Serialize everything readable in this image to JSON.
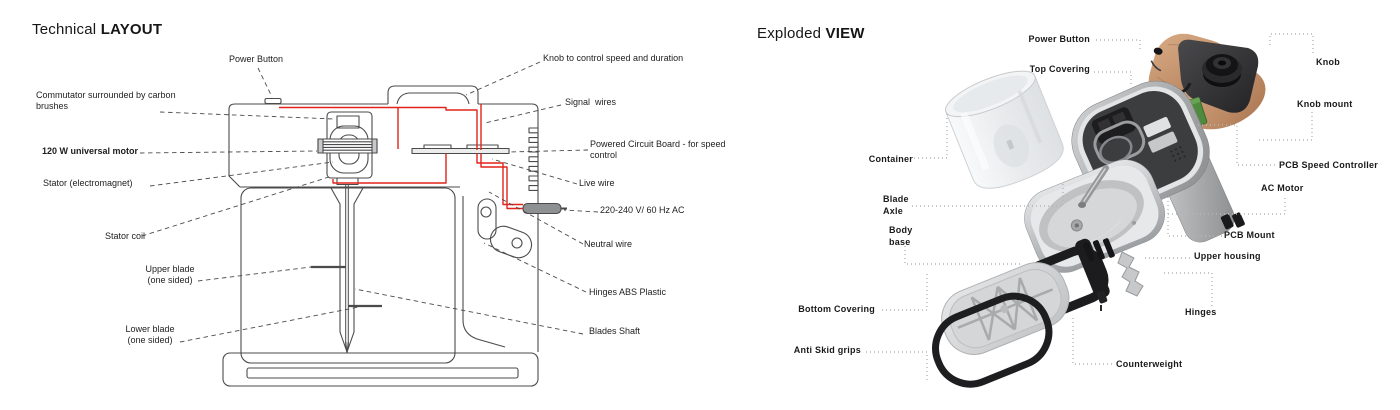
{
  "left": {
    "title_regular": "Technical ",
    "title_bold": "LAYOUT",
    "labels": {
      "power_button": "Power Button",
      "knob": "Knob to control speed and duration",
      "commutator_1": "Commutator surrounded by carbon",
      "commutator_2": "brushes",
      "signal_wires": "Signal  wires",
      "motor": "120 W universal motor",
      "pcb_1": "Powered Circuit Board - for speed",
      "pcb_2": "control",
      "stator": "Stator (electromagnet)",
      "live_wire": "Live wire",
      "voltage": "220-240 V/ 60 Hz AC",
      "stator_coil": "Stator coil",
      "neutral_wire": "Neutral wire",
      "upper_blade_1": "Upper blade",
      "upper_blade_2": "(one sided)",
      "hinges_abs": "Hinges ABS Plastic",
      "lower_blade_1": "Lower blade",
      "lower_blade_2": "(one sided)",
      "blades_shaft": "Blades Shaft"
    }
  },
  "right": {
    "title_regular": "Exploded ",
    "title_bold": "VIEW",
    "labels": {
      "power_button": "Power Button",
      "top_covering": "Top Covering",
      "knob": "Knob",
      "knob_mount": "Knob mount",
      "container": "Container",
      "pcb_speed_controller": "PCB Speed Controller",
      "ac_motor": "AC Motor",
      "blade_axle_1": "Blade",
      "blade_axle_2": "Axle",
      "pcb_mount": "PCB Mount",
      "body_base_1": "Body",
      "body_base_2": "base",
      "upper_housing": "Upper housing",
      "bottom_covering": "Bottom Covering",
      "hinges": "Hinges",
      "anti_skid": "Anti Skid grips",
      "counterweight": "Counterweight"
    }
  },
  "colors": {
    "wire_red": "#e2231a",
    "outline_dark": "#4b4b4d",
    "leader_dotted": "#b4b6b8",
    "wood": "#c59a77",
    "plastic_dark": "#2a2a2c",
    "pcb_green": "#4f8a3e",
    "housing_gray": "#a6a8aa",
    "background": "#ffffff"
  }
}
